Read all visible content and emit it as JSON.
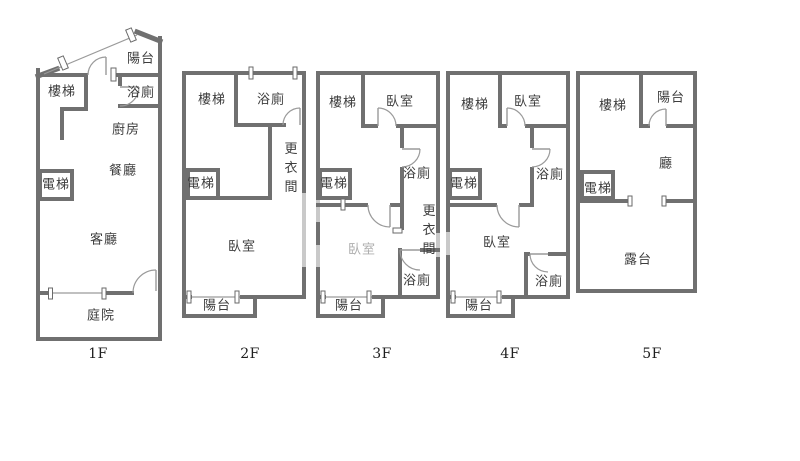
{
  "palette": {
    "wall": "#707070",
    "window": "#c9c9c9",
    "thin_line": "#9a9a9a",
    "label_text": "#3d3d3d",
    "label_text_faded": "#aeaeae",
    "caption_text": "#1f1f1f",
    "background": "#ffffff"
  },
  "floors": [
    {
      "caption": "1F",
      "rooms": {
        "balcony": "陽台",
        "stairs": "樓梯",
        "bath": "浴廁",
        "kitchen": "廚房",
        "dining": "餐廳",
        "elevator": "電梯",
        "living": "客廳",
        "yard": "庭院"
      }
    },
    {
      "caption": "2F",
      "rooms": {
        "stairs": "樓梯",
        "bath": "浴廁",
        "dressing": "更衣間",
        "elevator": "電梯",
        "bedroom": "臥室",
        "balcony": "陽台"
      }
    },
    {
      "caption": "3F",
      "rooms": {
        "stairs": "樓梯",
        "bedroom_top": "臥室",
        "bath_upper": "浴廁",
        "elevator": "電梯",
        "dressing": "更衣間",
        "bedroom_main": "臥室",
        "bath_lower": "浴廁",
        "balcony": "陽台"
      }
    },
    {
      "caption": "4F",
      "rooms": {
        "stairs": "樓梯",
        "bedroom_top": "臥室",
        "bath_upper": "浴廁",
        "elevator": "電梯",
        "bedroom_main": "臥室",
        "bath_lower": "浴廁",
        "balcony": "陽台"
      }
    },
    {
      "caption": "5F",
      "rooms": {
        "stairs": "樓梯",
        "balcony": "陽台",
        "hall": "廳",
        "elevator": "電梯",
        "terrace": "露台"
      }
    }
  ]
}
